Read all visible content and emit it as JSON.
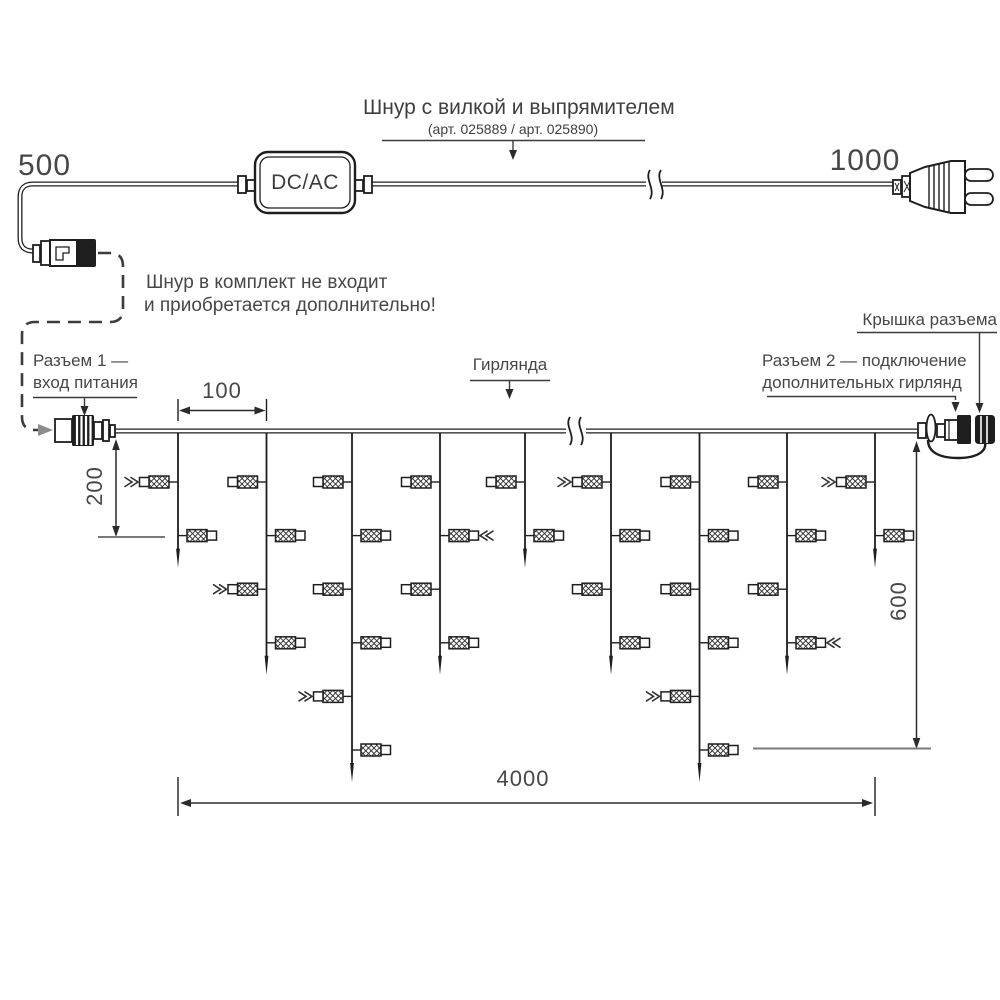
{
  "power_cord": {
    "length_left": "500",
    "length_right": "1000",
    "adapter_label": "DC/AC",
    "title": "Шнур с вилкой и выпрямителем",
    "subtitle": "(арт. 025889 / арт. 025890)"
  },
  "note": {
    "line1": "Шнур в комплект не входит",
    "line2": "и приобретается дополнительно!"
  },
  "labels": {
    "connector1_line1": "Разъем 1 —",
    "connector1_line2": "вход питания",
    "garland": "Гирлянда",
    "cap": "Крышка разъема",
    "connector2_line1": "Разъем 2 — подключение",
    "connector2_line2": "дополнительных гирлянд"
  },
  "dimensions": {
    "drop_spacing": "100",
    "first_lamp_offset": "200",
    "max_drop_length": "600",
    "total_length": "4000"
  },
  "colors": {
    "line": "#1e1e1e",
    "text": "#474747"
  },
  "garland": {
    "wire_y": 431,
    "row_start": 482,
    "row_gap": 53.6,
    "drops": [
      {
        "x": 178,
        "lamps": 2,
        "flash": [
          0
        ]
      },
      {
        "x": 266.5,
        "lamps": 4,
        "flash": [
          2
        ]
      },
      {
        "x": 352,
        "lamps": 6,
        "flash": [
          4
        ]
      },
      {
        "x": 440,
        "lamps": 4,
        "flash": [
          1
        ]
      },
      {
        "x": 525,
        "lamps": 2,
        "flash": []
      },
      {
        "x": 611,
        "lamps": 4,
        "flash": [
          0
        ]
      },
      {
        "x": 699.5,
        "lamps": 6,
        "flash": [
          4
        ]
      },
      {
        "x": 787,
        "lamps": 4,
        "flash": [
          3
        ]
      },
      {
        "x": 875,
        "lamps": 2,
        "flash": [
          0
        ]
      }
    ]
  }
}
